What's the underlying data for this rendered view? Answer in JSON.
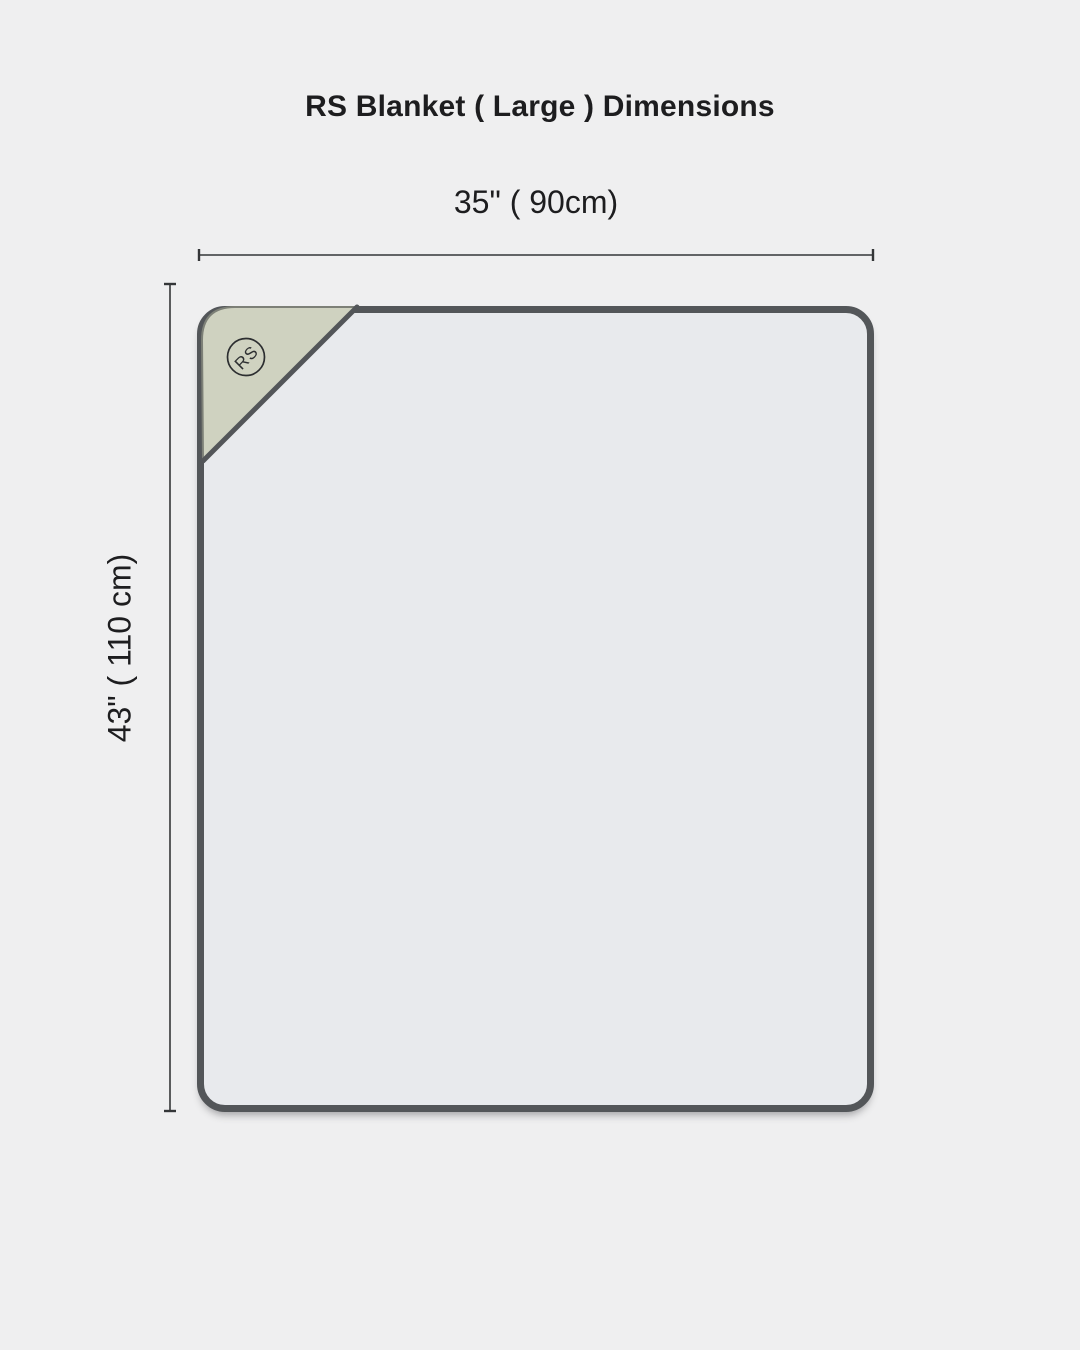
{
  "title": "RS Blanket ( Large ) Dimensions",
  "diagram": {
    "width_label": "35\" ( 90cm)",
    "height_label": "43\" ( 110 cm)",
    "logo_text": "RS"
  },
  "colors": {
    "background": "#efeff0",
    "blanket_fill": "#e8eaed",
    "blanket_border": "#535659",
    "fold_fill": "#cfd2c0",
    "fold_edge": "#7d8077",
    "dimension_line": "#343638",
    "text": "#1d1d1f"
  }
}
